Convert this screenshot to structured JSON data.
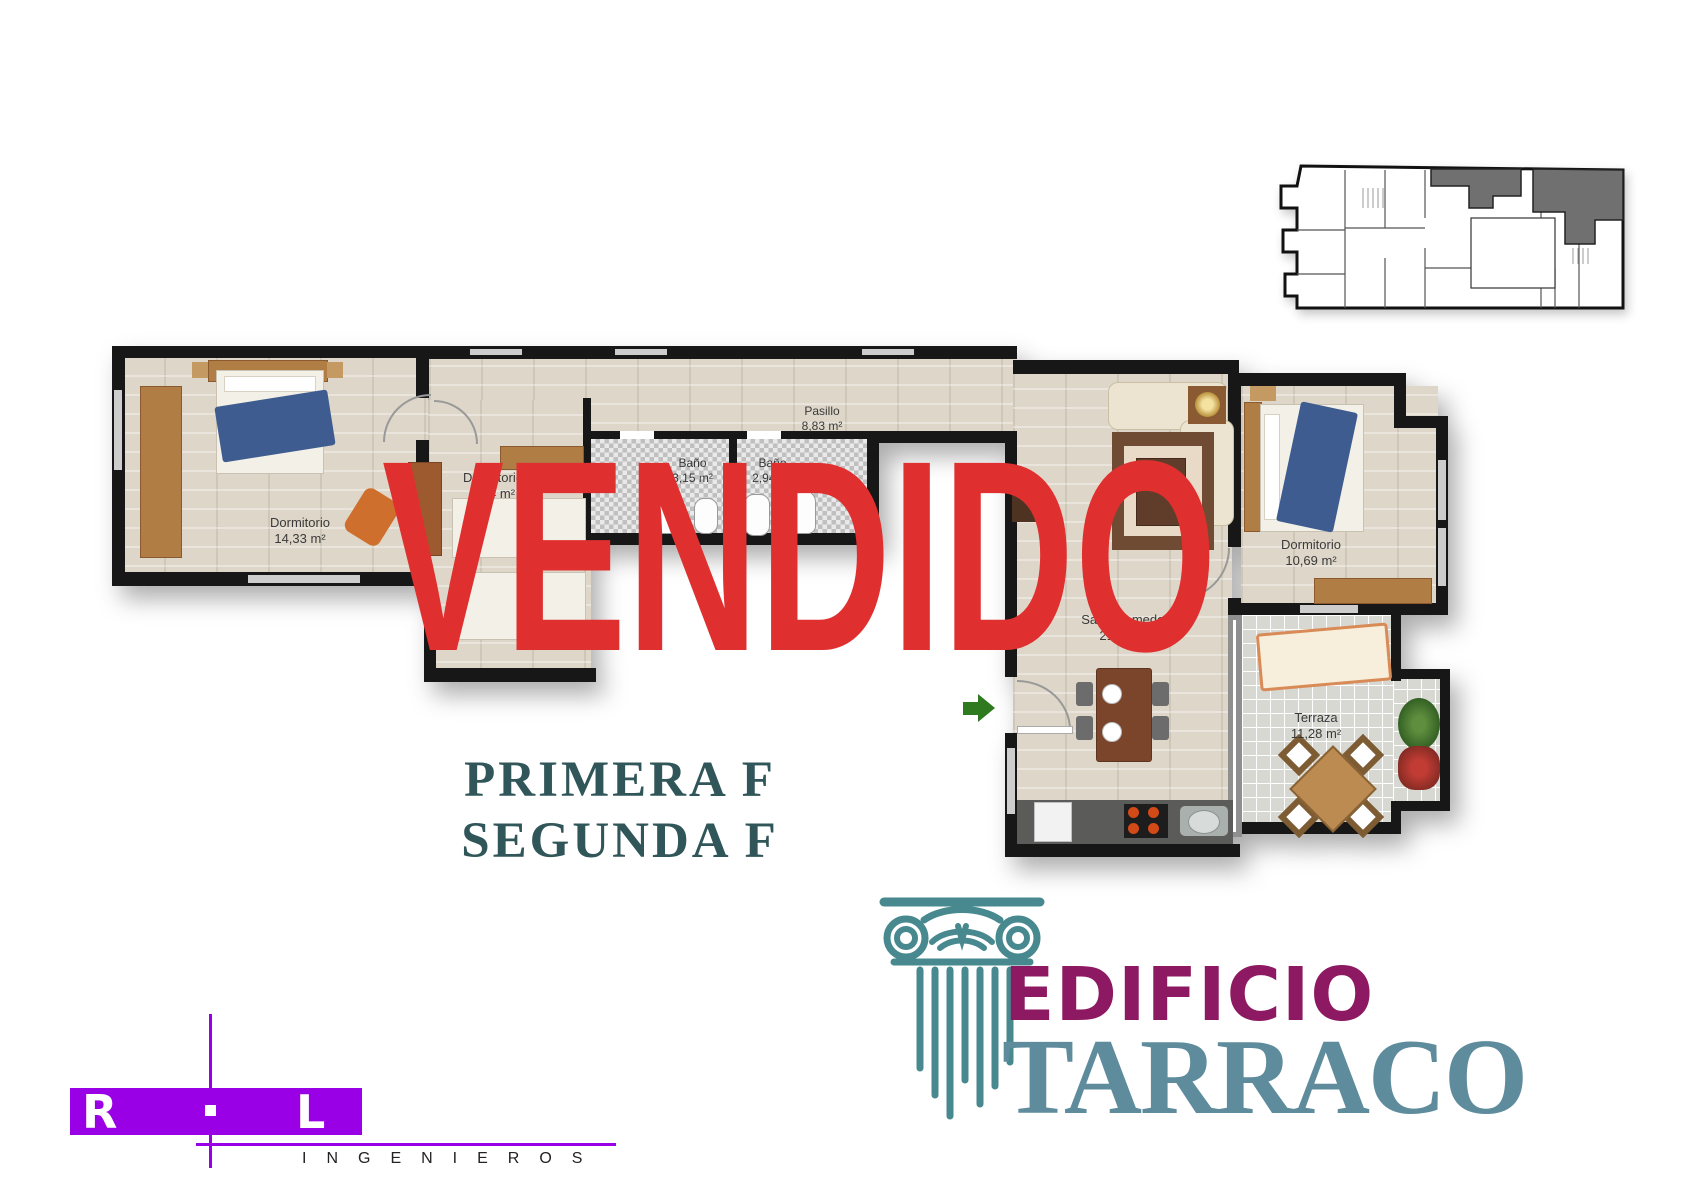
{
  "stamp": {
    "text": "VENDIDO",
    "color": "#e02f2f"
  },
  "floor_label": {
    "line1": "PRIMERA F",
    "line2": "SEGUNDA F",
    "color": "#315659"
  },
  "rooms": [
    {
      "name": "Dormitorio",
      "area": "14,33 m²"
    },
    {
      "name": "Dormitorio",
      "area": "7,74 m²"
    },
    {
      "name": "Baño",
      "area": "3,15 m²"
    },
    {
      "name": "Baño",
      "area": "2,94 m²"
    },
    {
      "name": "Pasillo",
      "area": "8,83 m²"
    },
    {
      "name": "Salón comedor",
      "area": "21,28 m²"
    },
    {
      "name": "Dormitorio",
      "area": "10,69 m²"
    },
    {
      "name": "Terraza",
      "area": "11,28 m²"
    }
  ],
  "brand": {
    "word1": "EDIFICIO",
    "word2": "TARRACO",
    "word1_color": "#8c1961",
    "word2_color": "#5e8c9c",
    "column_color": "#47898f"
  },
  "firm": {
    "initial_left": "R",
    "initial_right": "L",
    "subtitle": "INGENIEROS",
    "accent_color": "#9900e6"
  },
  "entrance_arrow_color": "#2f7a1f",
  "minimap": {
    "highlight_color": "#707070"
  }
}
